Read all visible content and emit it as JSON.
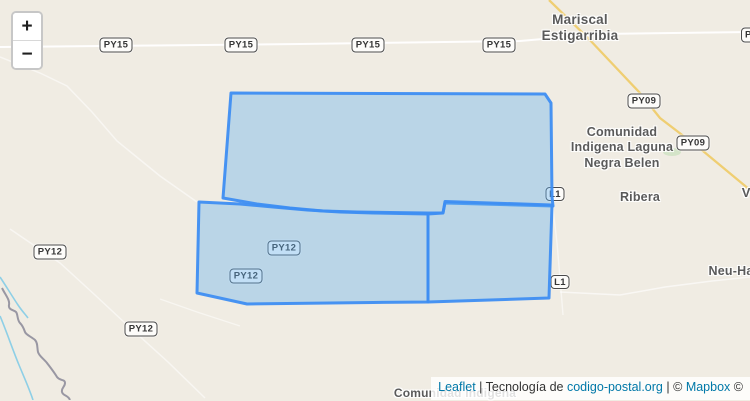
{
  "theme": {
    "map_bg": "#f0ece3",
    "polygon_stroke": "#3e8ef2",
    "polygon_fill": "#62b1ee",
    "road_major": "#ffffff",
    "road_yellow": "#efce72",
    "stream": "#8ecfe6",
    "river_boundary": "#8f8e9b",
    "park_green": "#cfe3c3",
    "label_color": "#5a5a5a",
    "shield_bg": "#fdfcfa",
    "shield_border": "#4b4b4b",
    "link_color": "#0078A8",
    "attribution_text_color": "#333333"
  },
  "controls": {
    "zoom_in_label": "+",
    "zoom_out_label": "−"
  },
  "shields": [
    {
      "label": "PY15",
      "x": 116,
      "y": 45
    },
    {
      "label": "PY15",
      "x": 241,
      "y": 45
    },
    {
      "label": "PY15",
      "x": 368,
      "y": 45
    },
    {
      "label": "PY15",
      "x": 499,
      "y": 45
    },
    {
      "label": "P",
      "x": 741,
      "y": 35,
      "w": 33,
      "partial": true
    },
    {
      "label": "PY09",
      "x": 644,
      "y": 101
    },
    {
      "label": "PY09",
      "x": 693,
      "y": 143
    },
    {
      "label": "PY12",
      "x": 284,
      "y": 248
    },
    {
      "label": "PY12",
      "x": 246,
      "y": 276
    },
    {
      "label": "PY12",
      "x": 50,
      "y": 252
    },
    {
      "label": "PY12",
      "x": 141,
      "y": 329
    },
    {
      "label": "L1",
      "x": 555,
      "y": 194,
      "w": 19,
      "h": 14
    },
    {
      "label": "L1",
      "x": 560,
      "y": 282,
      "w": 19,
      "h": 14
    }
  ],
  "place_labels": [
    {
      "id": "mariscal-estigarribia",
      "lines": [
        "Mariscal",
        "Estigarribia"
      ],
      "x": 580,
      "y": 12,
      "size": 13.5
    },
    {
      "id": "comunidad-indigena-laguna-negra-belen",
      "lines": [
        "Comunidad",
        "Indigena Laguna",
        "Negra Belen"
      ],
      "x": 622,
      "y": 125,
      "size": 12.5
    },
    {
      "id": "ribera",
      "lines": [
        "Ribera"
      ],
      "x": 640,
      "y": 190,
      "size": 12.5
    },
    {
      "id": "vi-partial",
      "lines": [
        "Vi"
      ],
      "x": 748,
      "y": 185,
      "size": 13
    },
    {
      "id": "neu-ha-partial",
      "lines": [
        "Neu-Ha"
      ],
      "x": 731,
      "y": 264,
      "size": 12.5
    },
    {
      "id": "comunidad-indigena-bottom",
      "lines": [
        "Comunidad Indigena"
      ],
      "x": 455,
      "y": 386,
      "size": 12
    }
  ],
  "attribution": {
    "leaflet_link": "Leaflet",
    "sep1": "|",
    "prefix": "Tecnología de",
    "provider_link": "codigo-postal.org",
    "sep2": "|",
    "copy1": "©",
    "mapbox_link": "Mapbox",
    "copy2": "©"
  }
}
